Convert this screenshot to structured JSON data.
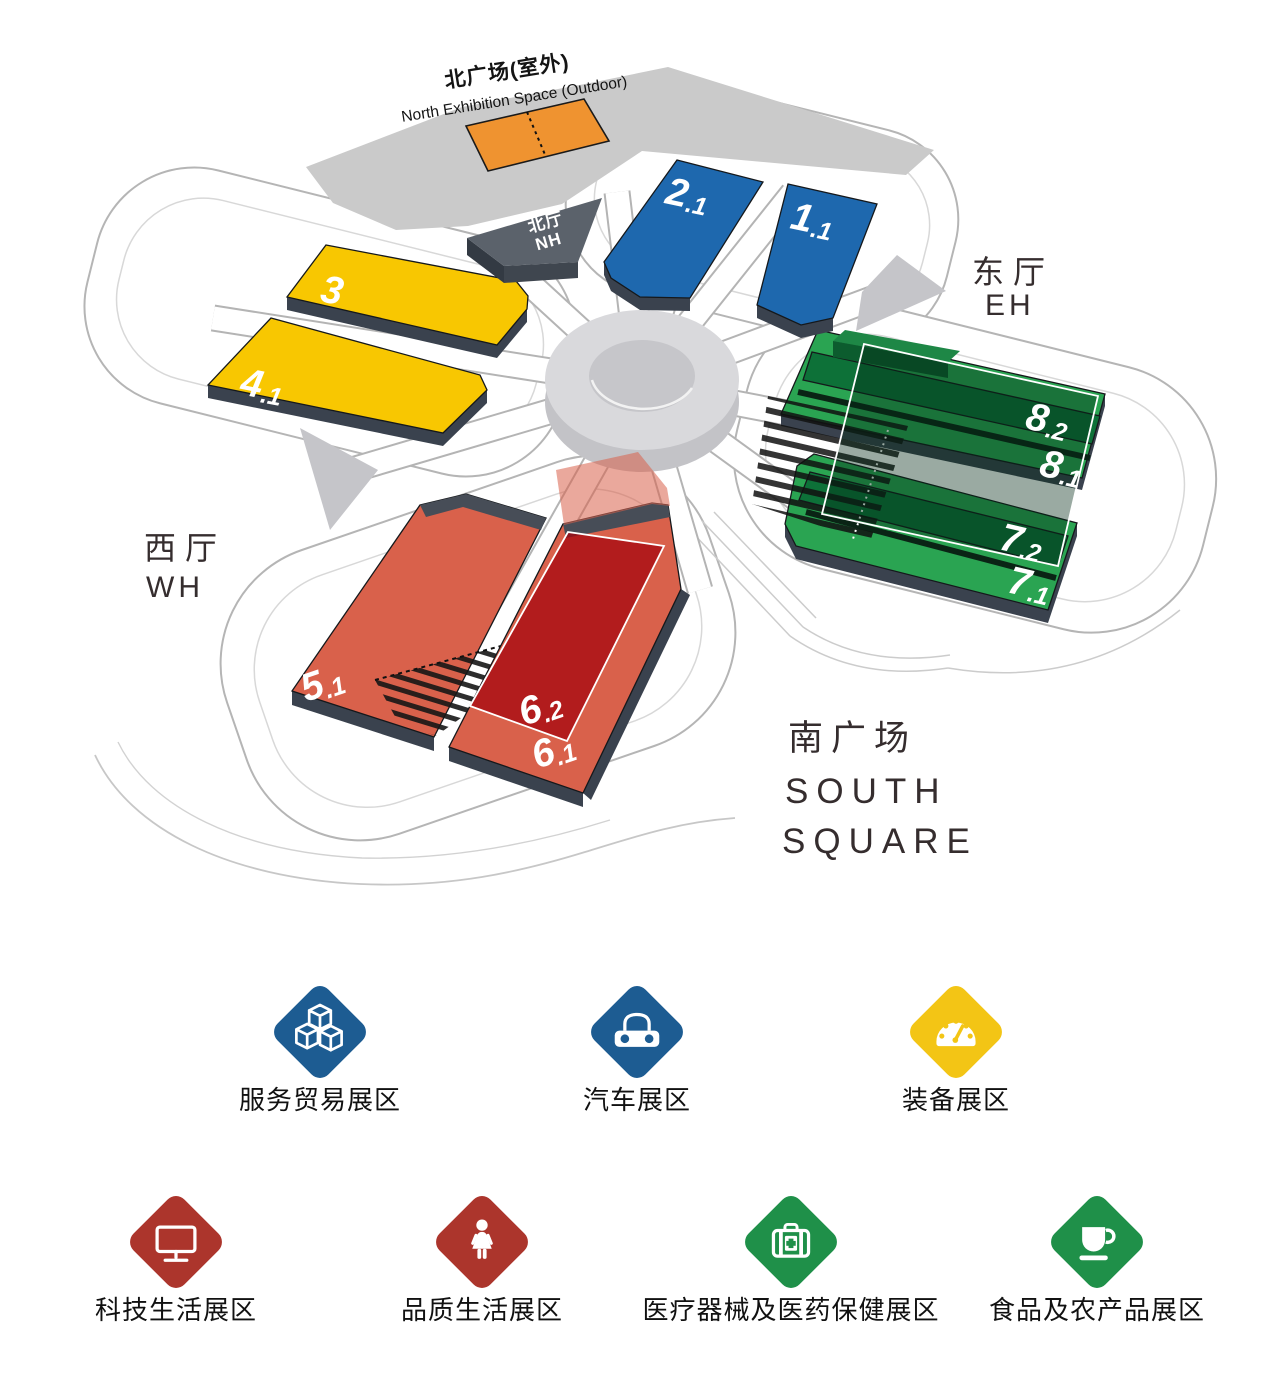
{
  "map": {
    "colors": {
      "blue": "#1e68ae",
      "yellow": "#f8c701",
      "green": "#2aa452",
      "green_dark": "#0d7138",
      "green_box_top": "#1e8746",
      "green_box_front": "#0c5c2e",
      "green_overlay": "rgba(3,42,22,0.40)",
      "red": "#d9614b",
      "red_overlay": "rgba(164,6,14,0.75)",
      "red_band": "rgba(217,97,74,0.55)",
      "orange": "#ef9330",
      "side": "#3a424e",
      "roof": "#474d57",
      "nh_top": "#5b626b",
      "nh_front": "#3f464f",
      "nh_side": "#333a43"
    },
    "north_square": {
      "zh": "北广场(室外)",
      "en": "North Exhibition Space (Outdoor)"
    },
    "north_hall": {
      "zh": "北厅",
      "en": "NH"
    },
    "east_hall": {
      "zh": "东厅",
      "en": "EH"
    },
    "west_hall": {
      "zh": "西厅",
      "en": "WH"
    },
    "south_square": {
      "zh": "南广场",
      "en1": "SOUTH",
      "en2": "SQUARE"
    },
    "halls": [
      {
        "name": "hall-2.1",
        "main": "2",
        "sub": ".1"
      },
      {
        "name": "hall-1.1",
        "main": "1",
        "sub": ".1"
      },
      {
        "name": "hall-3",
        "main": "3",
        "sub": ""
      },
      {
        "name": "hall-4.1",
        "main": "4",
        "sub": ".1"
      },
      {
        "name": "hall-8.2",
        "main": "8",
        "sub": ".2"
      },
      {
        "name": "hall-8.1",
        "main": "8",
        "sub": ".1"
      },
      {
        "name": "hall-7.2",
        "main": "7",
        "sub": ".2"
      },
      {
        "name": "hall-7.1",
        "main": "7",
        "sub": ".1"
      },
      {
        "name": "hall-5.1",
        "main": "5",
        "sub": ".1"
      },
      {
        "name": "hall-6.2",
        "main": "6",
        "sub": ".2"
      },
      {
        "name": "hall-6.1",
        "main": "6",
        "sub": ".1"
      }
    ]
  },
  "legend": {
    "rows": [
      [
        {
          "label": "服务贸易展区",
          "color": "#1d5c92",
          "icon": "cubes-icon"
        },
        {
          "label": "汽车展区",
          "color": "#1d5c92",
          "icon": "car-icon"
        },
        {
          "label": "装备展区",
          "color": "#f3c515",
          "icon": "gauge-icon"
        }
      ],
      [
        {
          "label": "科技生活展区",
          "color": "#ac352c",
          "icon": "monitor-icon"
        },
        {
          "label": "品质生活展区",
          "color": "#ac352c",
          "icon": "woman-icon"
        },
        {
          "label": "医疗器械及医药保健展区",
          "color": "#1f9049",
          "icon": "medkit-icon"
        },
        {
          "label": "食品及农产品展区",
          "color": "#1f9049",
          "icon": "cup-icon"
        }
      ]
    ]
  }
}
